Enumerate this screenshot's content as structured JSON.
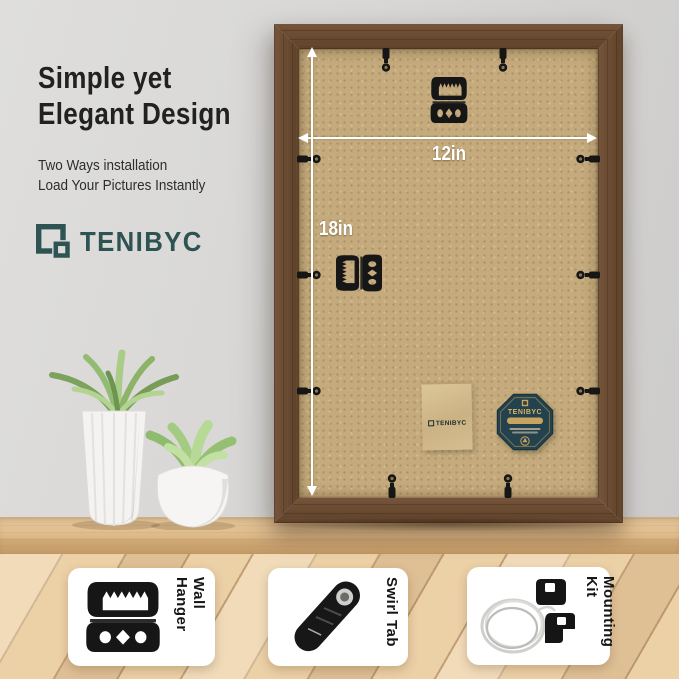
{
  "intro": {
    "title_line1": "Simple yet",
    "title_line2": "Elegant Design",
    "subtitle_line1": "Two Ways installation",
    "subtitle_line2": "Load Your Pictures Instantly",
    "brand": "TENIBYC"
  },
  "frame_annotations": {
    "width_label": "12in",
    "height_label": "18in"
  },
  "accessory_pouch": {
    "brand": "TENIBYC"
  },
  "quality_badge": {
    "brand": "TENIBYC"
  },
  "hardware_cards": [
    {
      "label": "Wall Hanger"
    },
    {
      "label": "Swirl Tab"
    },
    {
      "label": "Mounting Kit"
    }
  ],
  "colors": {
    "brand_teal": "#2e5353",
    "frame_wood": "#66492f",
    "backboard_tan": "#c4aa7c",
    "badge_navy": "#24424d",
    "badge_gold": "#c8a45f",
    "annotation_white": "#ffffff"
  }
}
